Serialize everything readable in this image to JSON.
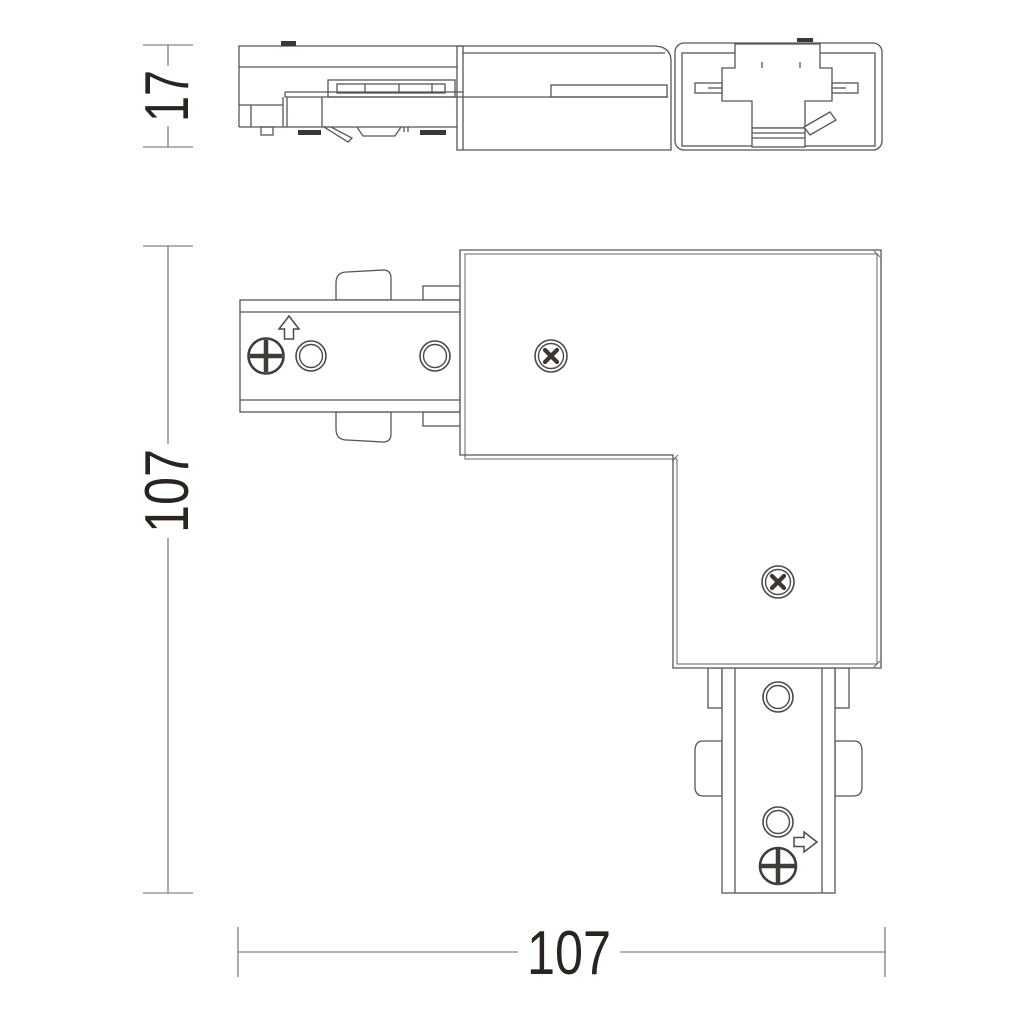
{
  "style": {
    "background": "#ffffff",
    "line_color": "#5a5551",
    "dark_fill": "#3c3733",
    "text_color": "#2a241f"
  },
  "dimensions": {
    "side_height": "17",
    "plan_height": "107",
    "plan_width": "107"
  },
  "icons": {
    "arrow_up": "arrow-up-icon",
    "arrow_right": "arrow-right-icon",
    "phillips_screw": "phillips-screw-icon",
    "cross_screw": "cross-screw-icon",
    "mount_hole": "mount-hole"
  }
}
